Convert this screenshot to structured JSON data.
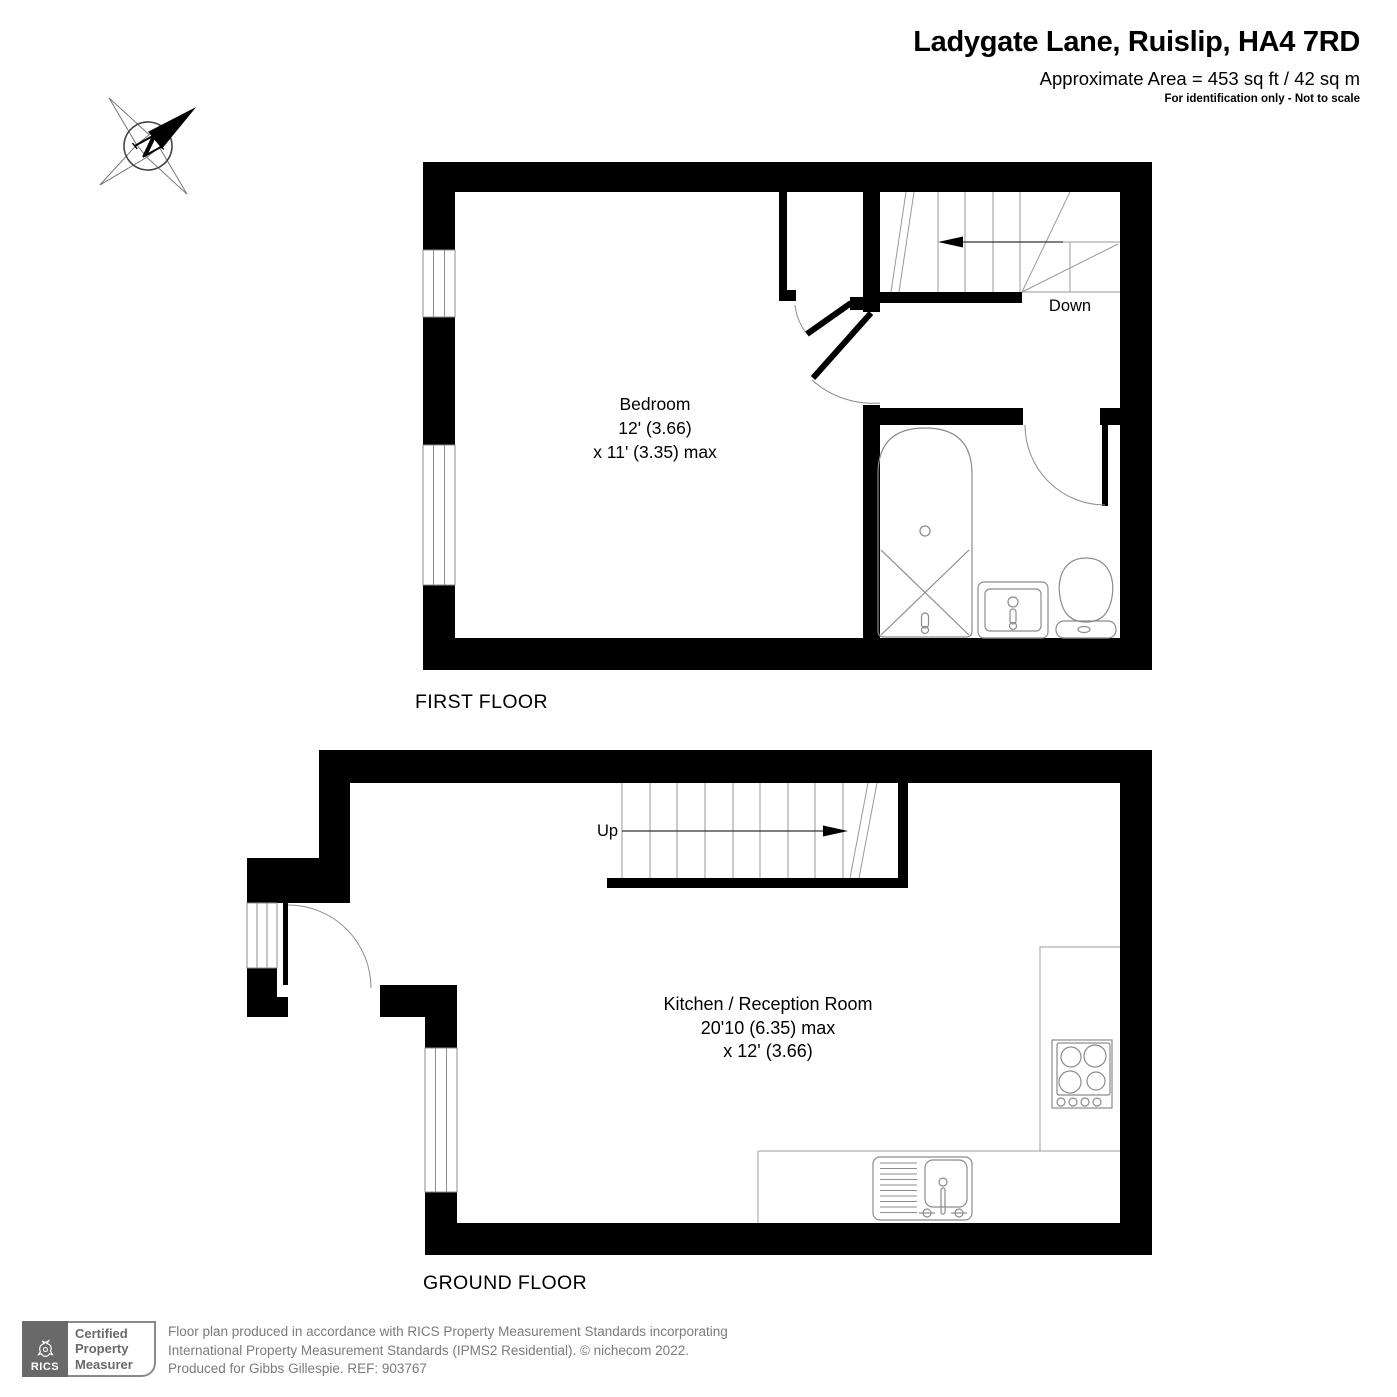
{
  "header": {
    "title": "Ladygate Lane, Ruislip, HA4 7RD",
    "area": "Approximate Area = 453 sq ft / 42 sq m",
    "disclaimer": "For identification only - Not to scale"
  },
  "compass": {
    "letter": "N"
  },
  "floors": {
    "first": {
      "label": "FIRST FLOOR",
      "room_name": "Bedroom",
      "dim_line1": "12' (3.66)",
      "dim_line2": "x 11' (3.35) max",
      "stair_label": "Down",
      "fixtures": [
        "bath",
        "sink",
        "toilet",
        "stairs-down",
        "windows",
        "doors"
      ]
    },
    "ground": {
      "label": "GROUND FLOOR",
      "room_name": "Kitchen / Reception Room",
      "dim_line1": "20'10 (6.35) max",
      "dim_line2": "x 12' (3.66)",
      "stair_label": "Up",
      "fixtures": [
        "stairs-up",
        "entry-door",
        "kitchen-counter",
        "hob",
        "sink-drainer",
        "windows"
      ]
    }
  },
  "footer": {
    "badge_brand": "RICS",
    "badge_line1": "Certified",
    "badge_line2": "Property",
    "badge_line3": "Measurer",
    "line1": "Floor plan produced in accordance with RICS Property Measurement Standards incorporating",
    "line2": "International Property Measurement Standards (IPMS2 Residential).  © nichecom 2022.",
    "line3": "Produced for Gibbs Gillespie.   REF: 903767"
  },
  "colors": {
    "wall": "#000000",
    "fixture": "#8c8c8c",
    "footer_text": "#7b7b7b",
    "badge_gray": "#696969"
  }
}
